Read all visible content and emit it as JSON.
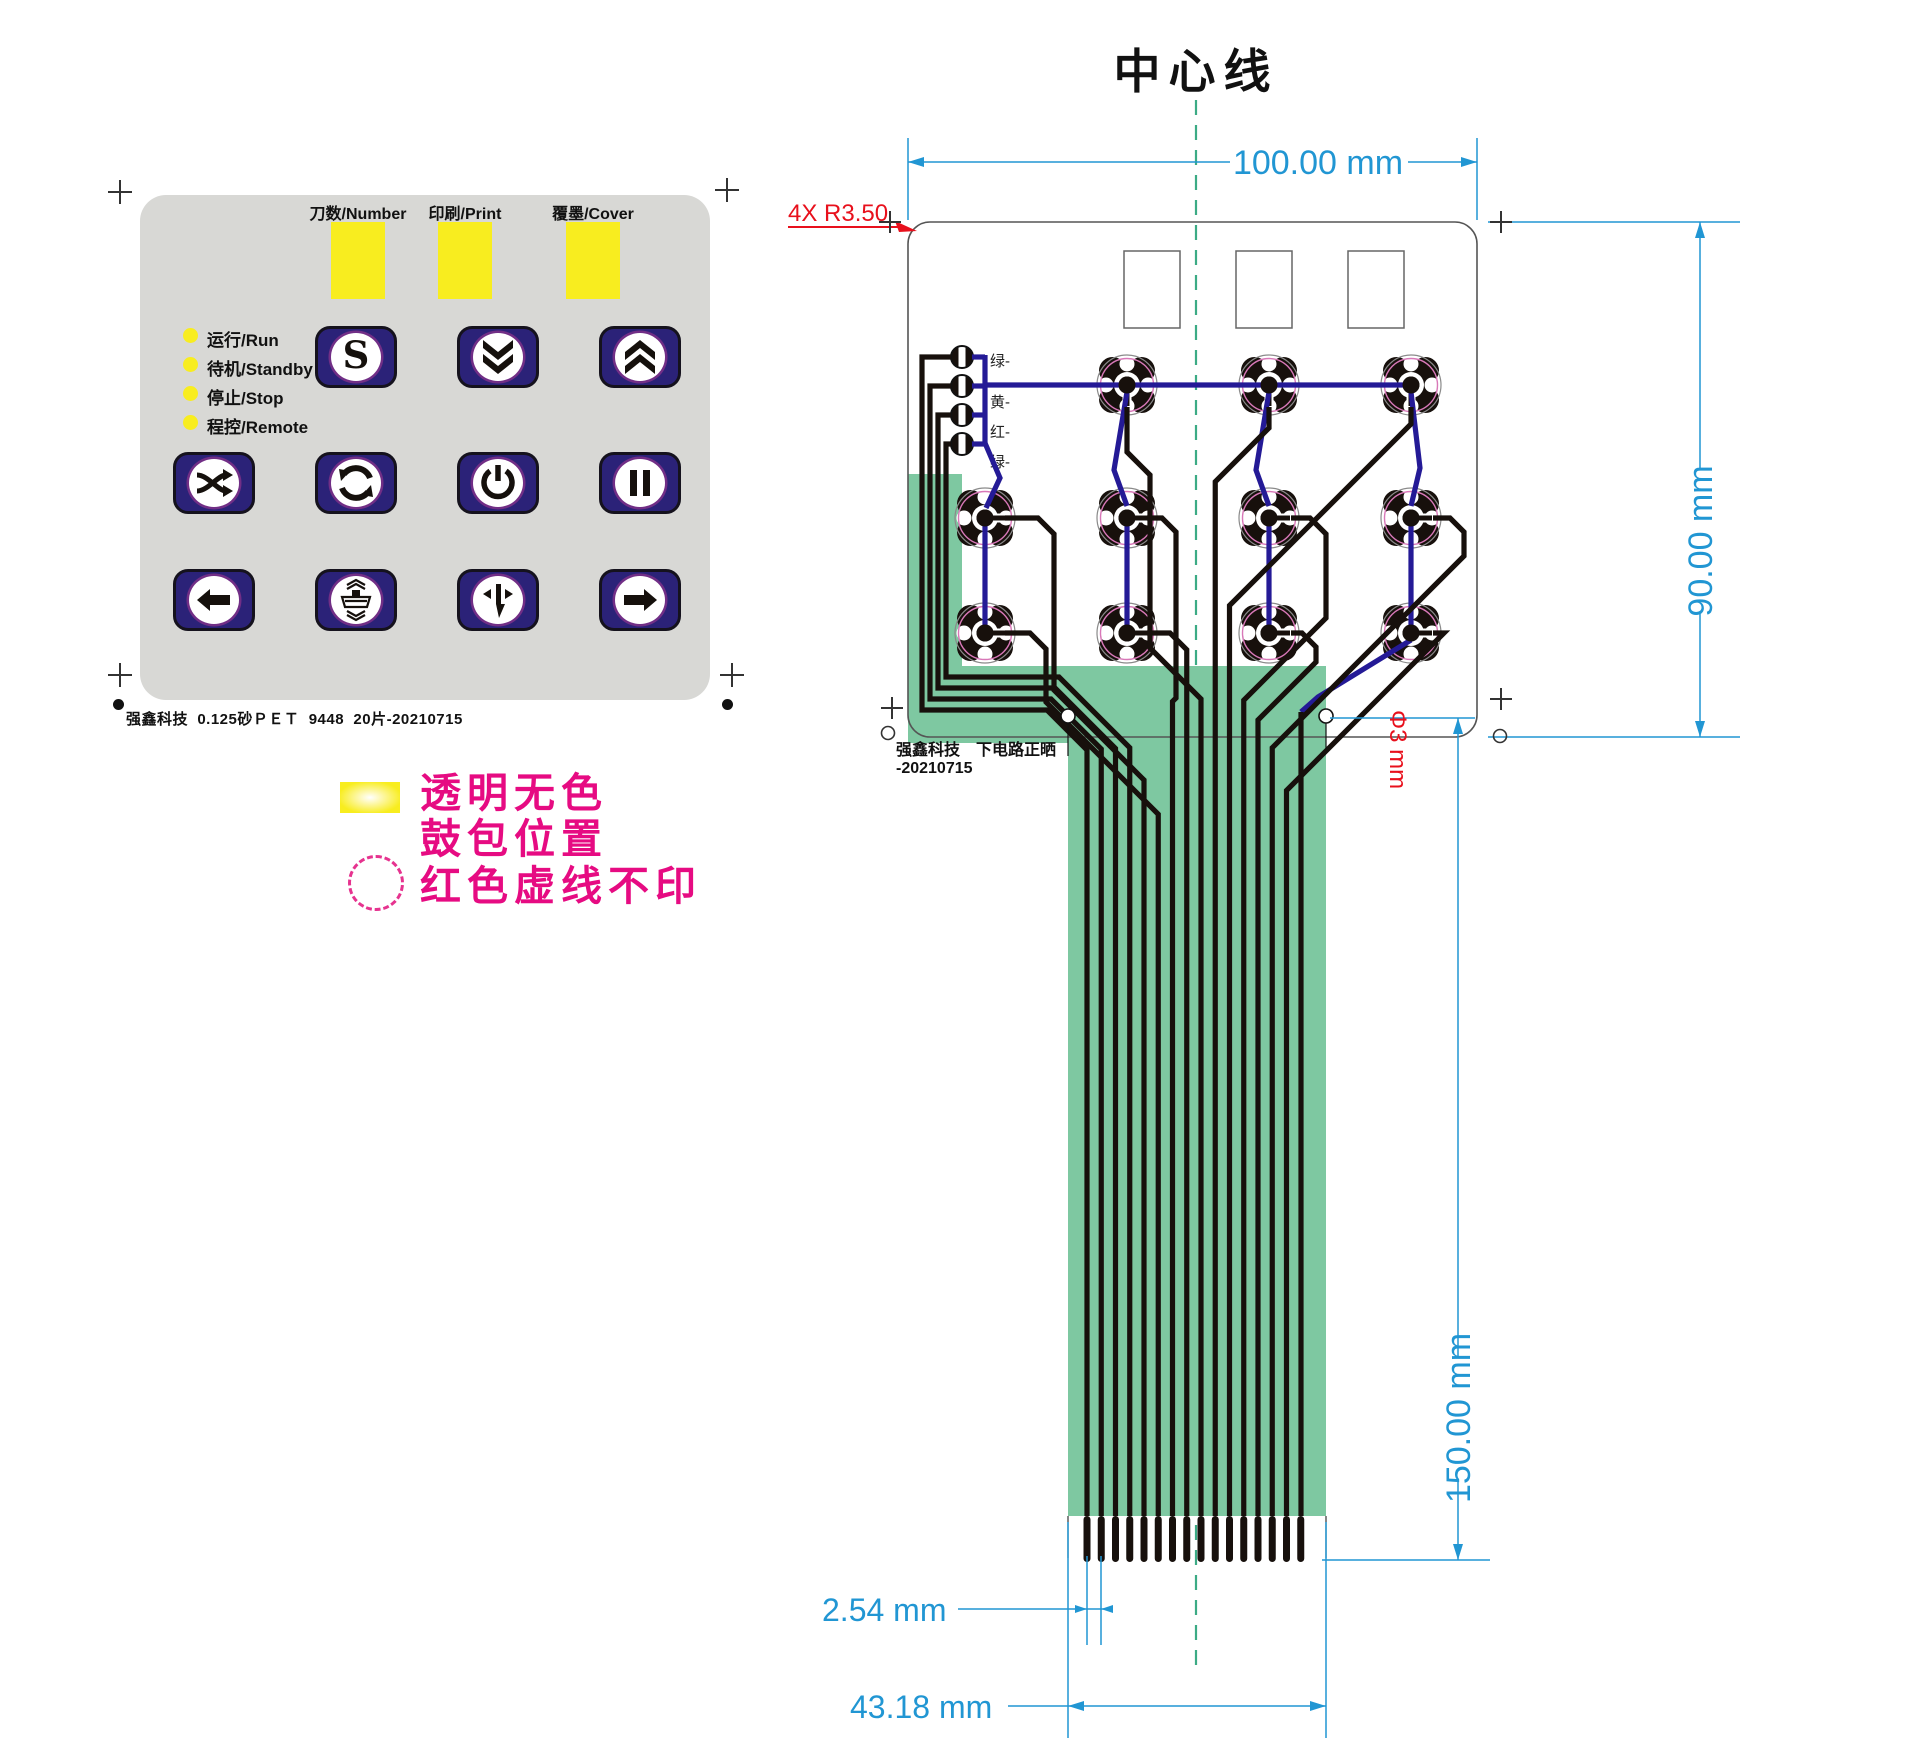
{
  "keypad": {
    "window_labels": [
      "刀数/Number",
      "印刷/Print",
      "覆墨/Cover"
    ],
    "status_leds": [
      {
        "label": "运行/Run"
      },
      {
        "label": "待机/Standby"
      },
      {
        "label": "停止/Stop"
      },
      {
        "label": "程控/Remote"
      }
    ],
    "buttons": [
      {
        "icon": "s-icon",
        "label": "S"
      },
      {
        "icon": "chevron-double-down-icon"
      },
      {
        "icon": "chevron-double-up-icon"
      },
      {
        "icon": "shuffle-icon"
      },
      {
        "icon": "cycle-icon"
      },
      {
        "icon": "power-icon"
      },
      {
        "icon": "pause-icon"
      },
      {
        "icon": "arrow-left-icon"
      },
      {
        "icon": "press-icon"
      },
      {
        "icon": "arrow-down-split-icon"
      },
      {
        "icon": "arrow-right-icon"
      }
    ],
    "footer": "强鑫科技  0.125砂ＰＥＴ  9448  20片-20210715"
  },
  "legend": {
    "line1": "透明无色",
    "line2": "鼓包位置",
    "line3": "红色虚线不印"
  },
  "circuit": {
    "title": "中心线",
    "dims": {
      "width": "100.00 mm",
      "height": "90.00 mm",
      "tail_length": "150.00 mm",
      "pitch": "2.54 mm",
      "tail_width": "43.18 mm",
      "corner_radius": "4X R3.50",
      "hole_dia": "Φ3 mm"
    },
    "wire_labels": [
      "绿-",
      "黄-",
      "红-",
      "绿-"
    ],
    "footer_line1": "强鑫科技　下电路正晒",
    "footer_line2": "-20210715"
  },
  "colors": {
    "panel_gray": "#d8d8d5",
    "button_navy": "#2b2278",
    "window_yellow": "#f8ed1f",
    "legend_magenta": "#e60b82",
    "dimension_blue": "#2196d3",
    "annotation_red": "#e8101c",
    "ribbon_green": "#7ec8a1",
    "trace_blue": "#241a96",
    "trace_black": "#17100c",
    "centerline_green": "#3cab85"
  }
}
